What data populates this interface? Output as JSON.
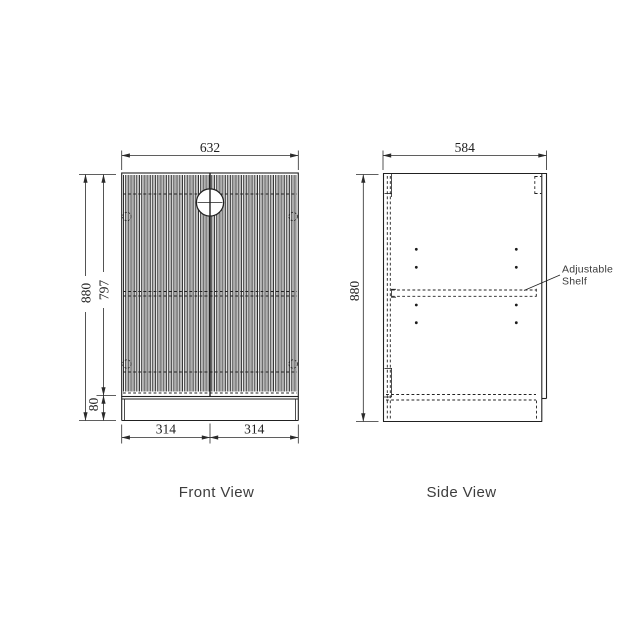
{
  "drawing": {
    "front": {
      "caption": "Front View",
      "dim_width": "632",
      "dim_height": "880",
      "dim_door_height": "797",
      "dim_plinth_height": "80",
      "dim_half_left": "314",
      "dim_half_right": "314"
    },
    "side": {
      "caption": "Side View",
      "dim_depth": "584",
      "dim_height": "880",
      "annotation": {
        "line1": "Adjustable",
        "line2": "Shelf"
      }
    },
    "colors": {
      "line": "#212121",
      "text": "#222222",
      "caption_text": "#3d3d3d",
      "slat_shade": "#a9a9a9",
      "background": "#ffffff"
    }
  }
}
